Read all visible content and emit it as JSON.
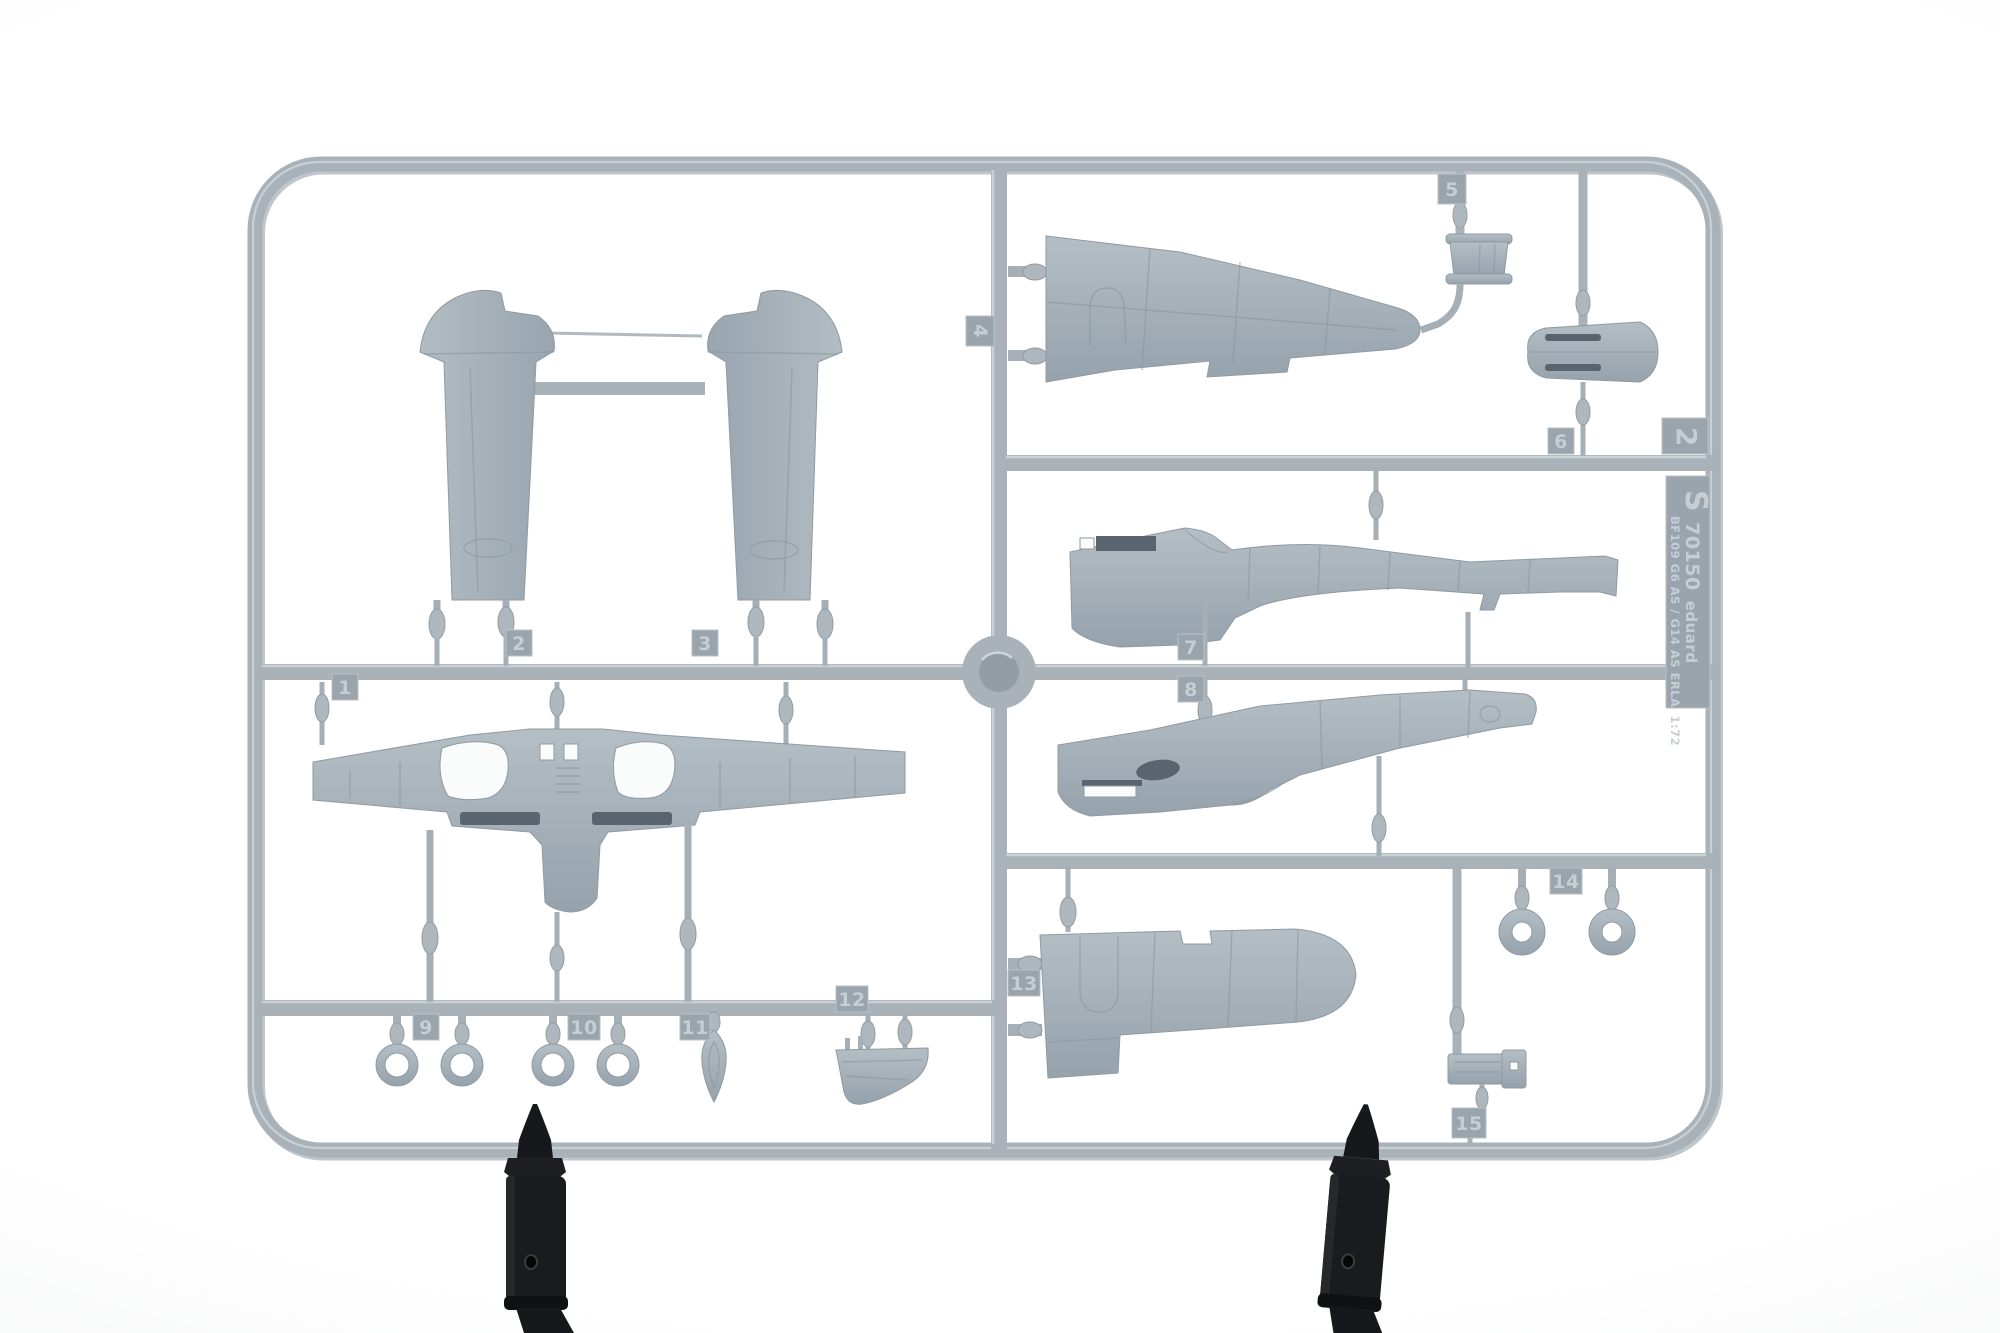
{
  "photo": {
    "subject": "Gray injection-molded model aircraft kit sprue (parts frame) held upright by two black plastic clamps against a white studio background",
    "colors": {
      "plastic": "#a9b2b8",
      "plastic_highlight": "#ced6da",
      "plastic_shadow": "#7f8a93",
      "background": "#f4f5f5",
      "clamp": "#17181b"
    },
    "clamps": {
      "count": "2"
    }
  },
  "markings": {
    "sprue_letter": "S",
    "catalog_number": "70150",
    "brand": "eduard",
    "kit_name": "BF109 G6 AS / G14 AS ERLA",
    "scale": "1:72",
    "cavity_number": "2"
  },
  "part_tabs": [
    {
      "number": "1",
      "depicts": "one-piece lower wing"
    },
    {
      "number": "2",
      "depicts": "upper wing half"
    },
    {
      "number": "3",
      "depicts": "upper wing half"
    },
    {
      "number": "4",
      "depicts": "wing panel"
    },
    {
      "number": "5",
      "depicts": "cylindrical drum part"
    },
    {
      "number": "6",
      "depicts": "cowling cone"
    },
    {
      "number": "7",
      "depicts": "fuselage half"
    },
    {
      "number": "8",
      "depicts": "fuselage half"
    },
    {
      "number": "9",
      "depicts": "small ring parts"
    },
    {
      "number": "10",
      "depicts": "small ring parts"
    },
    {
      "number": "11",
      "depicts": "teardrop fairing"
    },
    {
      "number": "12",
      "depicts": "curved panel"
    },
    {
      "number": "13",
      "depicts": "wing panel"
    },
    {
      "number": "14",
      "depicts": "wheel rings"
    },
    {
      "number": "15",
      "depicts": "equipment box"
    }
  ]
}
